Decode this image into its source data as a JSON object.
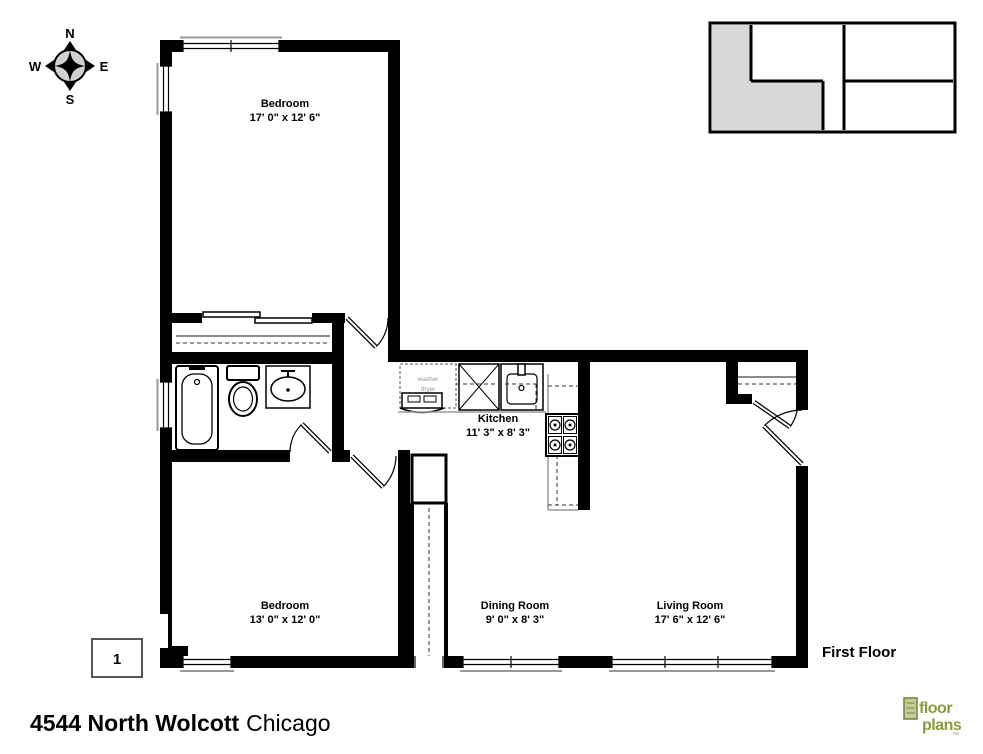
{
  "compass": {
    "north": "N",
    "south": "S",
    "east": "E",
    "west": "W"
  },
  "rooms": {
    "bedroom1": {
      "name": "Bedroom",
      "dims": "17' 0\" x 12' 6\""
    },
    "kitchen": {
      "name": "Kitchen",
      "dims": "11' 3\" x 8' 3\""
    },
    "bedroom2": {
      "name": "Bedroom",
      "dims": "13' 0\" x 12' 0\""
    },
    "dining": {
      "name": "Dining Room",
      "dims": "9' 0\" x 8' 3\""
    },
    "living": {
      "name": "Living Room",
      "dims": "17' 6\" x 12' 6\""
    }
  },
  "labels": {
    "floor": "First Floor",
    "page_number": "1",
    "washer": "washer",
    "dryer": "dryer"
  },
  "footer": {
    "address": "4544 North Wolcott",
    "city": "Chicago"
  },
  "logo": {
    "line1": "floor",
    "line2": "plans",
    "trademark": "™"
  },
  "colors": {
    "wall": "#000000",
    "keyplan_highlight": "#d8d8d8",
    "logo_green": "#8a9b3d"
  }
}
